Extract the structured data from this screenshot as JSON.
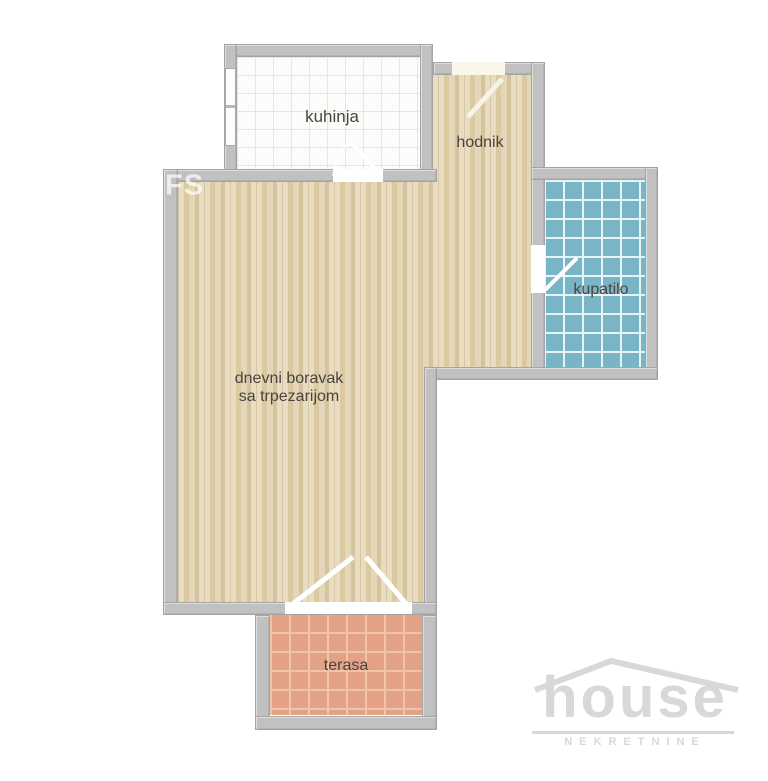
{
  "floorplan": {
    "rooms": [
      {
        "id": "kuhinja",
        "label": "kuhinja",
        "floor": "white-tile"
      },
      {
        "id": "hodnik",
        "label": "hodnik",
        "floor": "wood"
      },
      {
        "id": "kupatilo",
        "label": "kupatilo",
        "floor": "blue-tile"
      },
      {
        "id": "dnevni_boravak",
        "label_line1": "dnevni boravak",
        "label_line2": "sa trpezarijom",
        "floor": "wood"
      },
      {
        "id": "terasa",
        "label": "terasa",
        "floor": "terracotta-tile"
      }
    ],
    "watermark": ".FS",
    "logo": {
      "title": "house",
      "subtitle": "NEKRETNINE"
    }
  },
  "colors": {
    "wall": "#c1c1c1",
    "kitchen_tile": "#fcfcfb",
    "kitchen_grid": "#e6e6e2",
    "wood": "#ded0ae",
    "bathroom_tile": "#7ab5c7",
    "terrace_tile": "#e3a285",
    "terrace_grid": "#f1c4a9",
    "label": "#4a443e",
    "logo": "#d8d8d8"
  }
}
